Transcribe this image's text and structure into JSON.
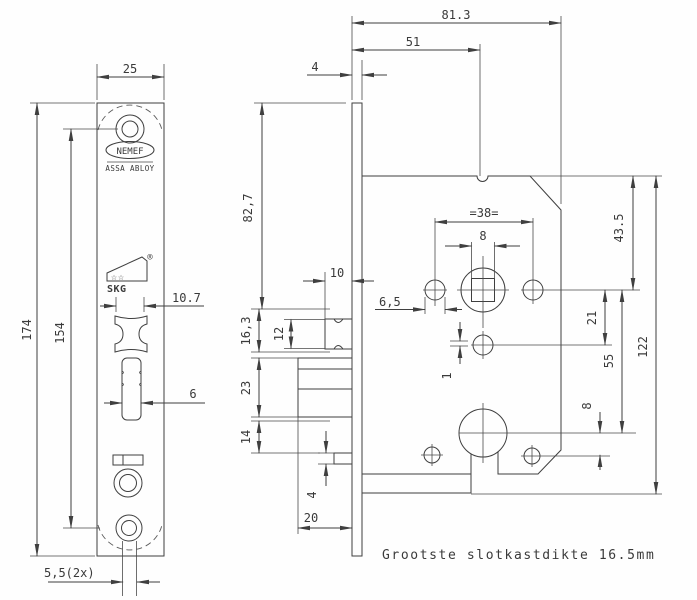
{
  "note": "Grootste slotkastdikte 16.5mm",
  "brand": {
    "name": "NEMEF",
    "group": "ASSA ABLOY",
    "cert_stars": "☆☆",
    "cert_name": "SKG",
    "registered": "®"
  },
  "front_view": {
    "plate_width": "25",
    "plate_height": "174",
    "hole_spacing": "154",
    "latch_cutout_width": "10.7",
    "deadbolt_slot_width": "6",
    "screw_hole_dia": "5,5(2x)"
  },
  "side_view": {
    "faceplate_thickness": "4",
    "total_depth": "81.3",
    "backset": "51",
    "top_to_latch": "82,7",
    "latch_cutout_height": "16,3",
    "latch_height": "12",
    "latch_throw": "10",
    "deadbolt_height": "23",
    "below_deadbolt": "14",
    "aux_pin_height": "4",
    "deadbolt_throw": "20",
    "handle_hole_spacing": "=38=",
    "spindle_square": "8",
    "handle_hole_dia": "6,5",
    "micro_offset": "1",
    "spindle_to_cylinder": "21",
    "spindle_to_keyhole": "55",
    "keyhole_to_screw": "8",
    "top_to_spindle": "43.5",
    "case_height": "122"
  }
}
